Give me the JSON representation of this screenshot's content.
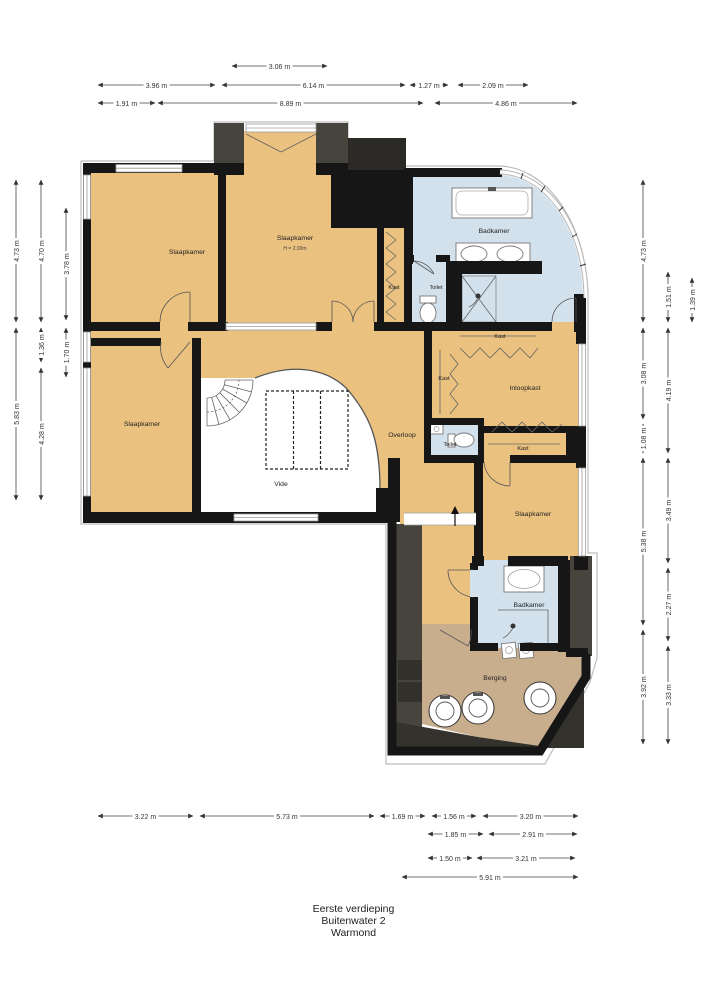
{
  "title": {
    "floor": "Eerste verdieping",
    "address": "Buitenwater 2",
    "city": "Warmond"
  },
  "rooms": {
    "slaapkamer_1": "Slaapkamer",
    "slaapkamer_2": "Slaapkamer",
    "slaapkamer_2_height": "H = 2.00m",
    "slaapkamer_3": "Slaapkamer",
    "slaapkamer_4": "Slaapkamer",
    "badkamer_1": "Badkamer",
    "badkamer_2": "Badkamer",
    "kast_1": "Kast",
    "kast_2": "Kast",
    "kast_3": "Kast",
    "kast_4": "Kast",
    "toilet_1": "Toilet",
    "toilet_2": "Toilet",
    "inloopkast": "Inloopkast",
    "overloop": "Overloop",
    "vide": "Vide",
    "berging": "Berging"
  },
  "dimensions": {
    "top": [
      "3.06 m",
      "3.96 m",
      "6.14 m",
      "1.27 m",
      "2.09 m",
      "1.91 m",
      "8.89 m",
      "4.86 m"
    ],
    "left": [
      "4.73 m",
      "5.83 m",
      "4.70 m",
      "1.36 m",
      "4.28 m",
      "3.78 m",
      "1.70 m"
    ],
    "right": [
      "4.73 m",
      "3.08 m",
      "1.08 m",
      "5.38 m",
      "3.92 m",
      "1.51 m",
      "4.19 m",
      "3.49 m",
      "2.27 m",
      "3.33 m",
      "1.39 m"
    ],
    "bottom": [
      "3.22 m",
      "5.73 m",
      "1.69 m",
      "1.56 m",
      "3.20 m",
      "1.85 m",
      "2.91 m",
      "1.50 m",
      "3.21 m",
      "5.91 m"
    ]
  },
  "colors": {
    "room_fill": "#EBC180",
    "bathroom_fill": "#D3E1ED",
    "storage_fill": "#C9AE8E",
    "wall": "#161616",
    "roof_dark": "#46443C",
    "roof_darker": "#34322C",
    "window_frame": "#9C9C9C",
    "dimension_line": "#444444"
  }
}
